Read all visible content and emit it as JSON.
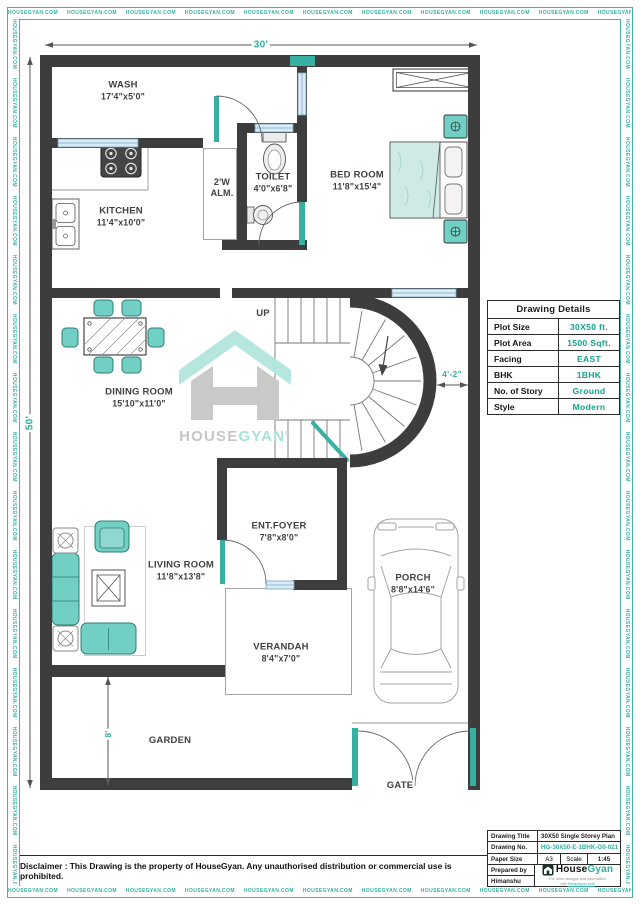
{
  "border": {
    "watermark_text": "HOUSEGYAN.COM"
  },
  "dimensions": {
    "top": "30'",
    "left": "50'",
    "stair": "4'-2\"",
    "garden": "8'"
  },
  "stairs": {
    "up_label": "UP"
  },
  "rooms": [
    {
      "id": "wash",
      "name": "WASH",
      "dims": "17'4\"x5'0\""
    },
    {
      "id": "kitchen",
      "name": "KITCHEN",
      "dims": "11'4\"x10'0\""
    },
    {
      "id": "alm",
      "name": "2'W ALM.",
      "dims": ""
    },
    {
      "id": "toilet",
      "name": "TOILET",
      "dims": "4'0\"x6'8\""
    },
    {
      "id": "bedroom",
      "name": "BED ROOM",
      "dims": "11'8\"x15'4\""
    },
    {
      "id": "dining",
      "name": "DINING ROOM",
      "dims": "15'10\"x11'0\""
    },
    {
      "id": "living",
      "name": "LIVING ROOM",
      "dims": "11'8\"x13'8\""
    },
    {
      "id": "foyer",
      "name": "ENT.FOYER",
      "dims": "7'8\"x8'0\""
    },
    {
      "id": "verandah",
      "name": "VERANDAH",
      "dims": "8'4\"x7'0\""
    },
    {
      "id": "porch",
      "name": "PORCH",
      "dims": "8'8\"x14'6\""
    },
    {
      "id": "garden",
      "name": "GARDEN",
      "dims": ""
    },
    {
      "id": "gate",
      "name": "GATE",
      "dims": ""
    }
  ],
  "details": {
    "title": "Drawing Details",
    "rows": [
      {
        "label": "Plot Size",
        "value": "30X50 ft."
      },
      {
        "label": "Plot Area",
        "value": "1500 Sqft."
      },
      {
        "label": "Facing",
        "value": "EAST"
      },
      {
        "label": "BHK",
        "value": "1BHK"
      },
      {
        "label": "No. of Story",
        "value": "Ground"
      },
      {
        "label": "Style",
        "value": "Modern"
      }
    ]
  },
  "title_block": {
    "drawing_title_label": "Drawing Title",
    "drawing_title": "30X50 Single Storey Plan",
    "drawing_no_label": "Drawing No.",
    "drawing_no": "HG-30X50-E-1BHK-G0-021",
    "paper_size_label": "Paper Size",
    "paper_size": "A3",
    "scale_label": "Scale",
    "scale": "1:45",
    "prepared_by_label": "Prepared by",
    "prepared_by": "Himanshu"
  },
  "watermark": {
    "house": "HOUSE",
    "gyan": "GYAN",
    "reg": "®"
  },
  "footer_logo": {
    "house": "House",
    "gyan": "Gyan",
    "tagline1": "For more designs and information",
    "tagline2_prefix": "visit ",
    "tagline2_link": "Housegyan.com"
  },
  "disclaimer": "Disclaimer : This Drawing is the property of HouseGyan. Any unauthorised distribution or commercial use is prohibited."
}
